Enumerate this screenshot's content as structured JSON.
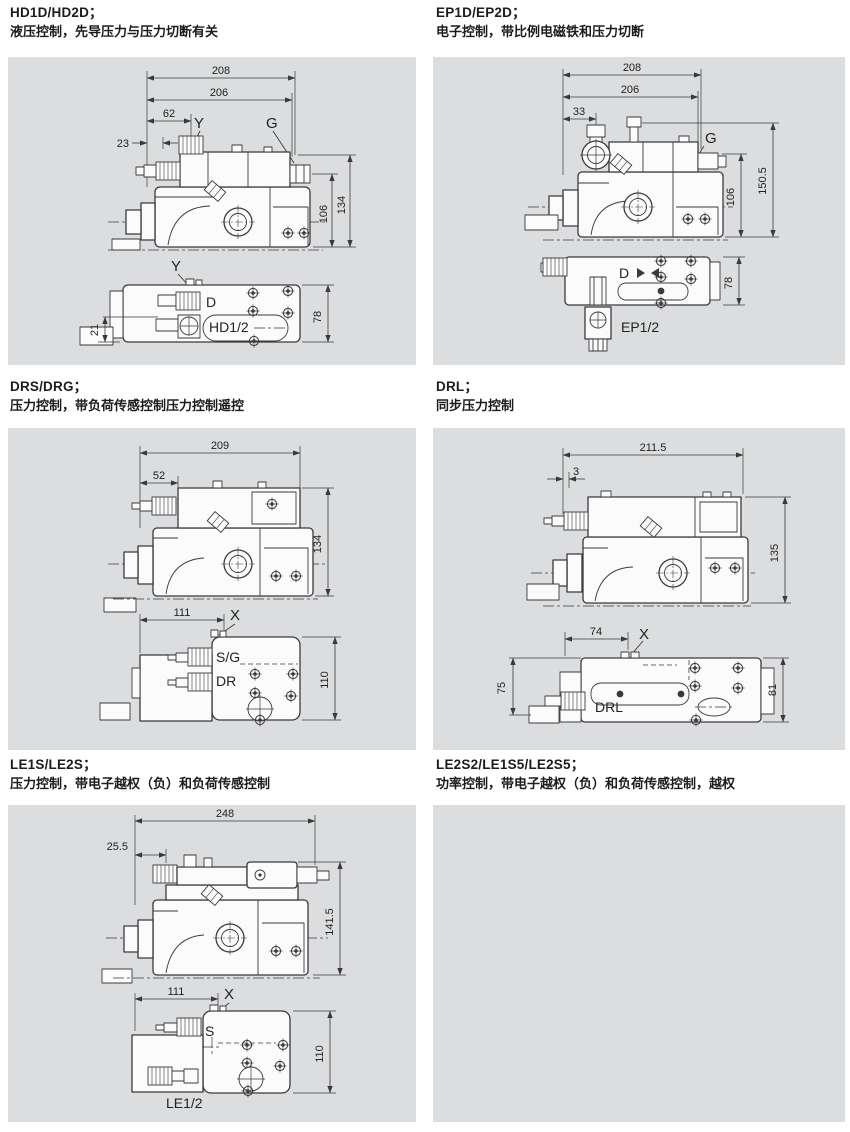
{
  "page": {
    "background": "#ffffff",
    "panel_background": "#dcddde",
    "line_color": "#3a3a3c"
  },
  "sections": [
    {
      "model": "HD1D/HD2D；",
      "desc": "液压控制，先导压力与压力切断有关",
      "fig": {
        "w1": "208",
        "w2": "206",
        "w3": "62",
        "w4": "23",
        "h1": "134",
        "h2": "106",
        "port_y": "Y",
        "port_g": "G",
        "b_port_y": "Y",
        "b_d": "D",
        "b_model": "HD1/2",
        "b_left": "21",
        "b_h": "78"
      }
    },
    {
      "model": "EP1D/EP2D；",
      "desc": "电子控制，带比例电磁铁和压力切断",
      "fig": {
        "w1": "208",
        "w2": "206",
        "w3": "33",
        "h1": "150.5",
        "h2": "106",
        "port_g": "G",
        "b_d": "D",
        "b_model": "EP1/2",
        "b_h": "78"
      }
    },
    {
      "model": "DRS/DRG；",
      "desc": "压力控制，带负荷传感控制压力控制遥控",
      "fig": {
        "w1": "209",
        "w2": "52",
        "h1": "134",
        "b_w": "111",
        "b_x": "X",
        "b_sg": "S/G",
        "b_dr": "DR",
        "b_h": "110"
      }
    },
    {
      "model": "DRL；",
      "desc": "同步压力控制",
      "fig": {
        "w1": "211.5",
        "w2": "3",
        "h1": "135",
        "b_w": "74",
        "b_x": "X",
        "b_left": "75",
        "b_model": "DRL",
        "b_h": "81"
      }
    },
    {
      "model": "LE1S/LE2S；",
      "desc": "压力控制，带电子越权（负）和负荷传感控制",
      "fig": {
        "w1": "248",
        "w2": "25.5",
        "h1": "141.5",
        "b_w": "111",
        "b_x": "X",
        "b_s": "S",
        "b_model": "LE1/2",
        "b_h": "110"
      }
    },
    {
      "model": "LE2S2/LE1S5/LE2S5；",
      "desc": "功率控制，带电子越权（负）和负荷传感控制，越权",
      "fig": {}
    }
  ]
}
